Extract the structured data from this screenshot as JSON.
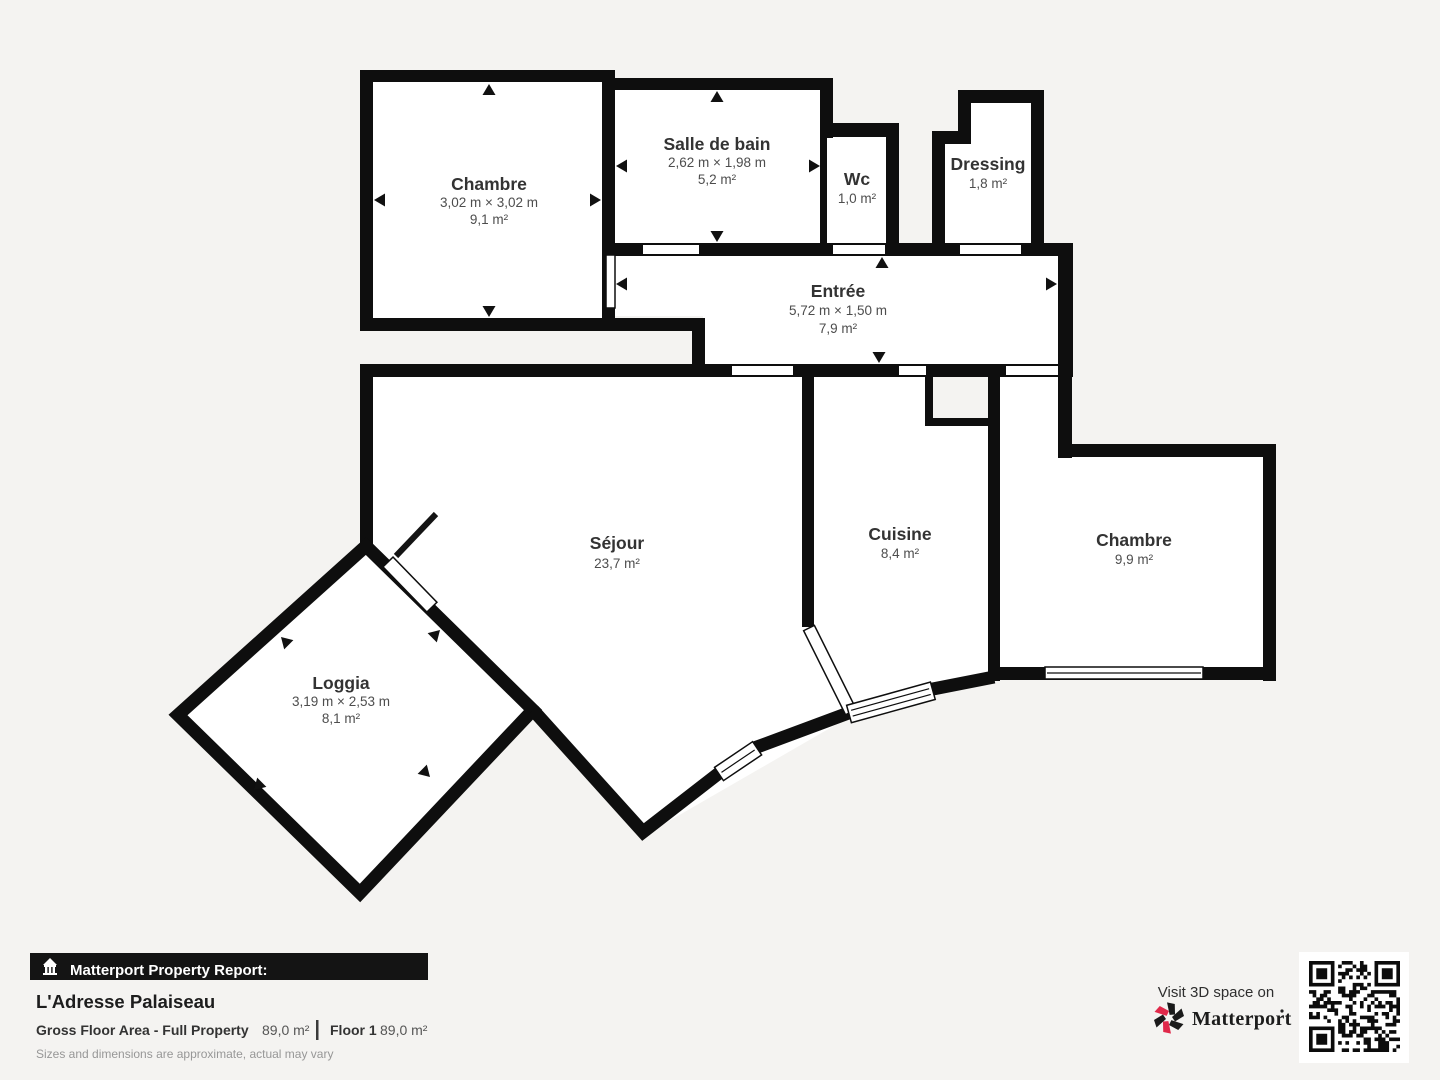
{
  "page": {
    "background": "#f4f3f1",
    "wall_color": "#0e0e0e",
    "accent_red": "#e0294a"
  },
  "plan": {
    "rooms": {
      "chambre1": {
        "name": "Chambre",
        "dims": "3,02 m × 3,02 m",
        "area": "9,1 m²"
      },
      "salle_de_bain": {
        "name": "Salle de bain",
        "dims": "2,62 m × 1,98 m",
        "area": "5,2 m²"
      },
      "wc": {
        "name": "Wc",
        "area": "1,0 m²"
      },
      "dressing": {
        "name": "Dressing",
        "area": "1,8 m²"
      },
      "entree": {
        "name": "Entrée",
        "dims": "5,72 m × 1,50 m",
        "area": "7,9 m²"
      },
      "sejour": {
        "name": "Séjour",
        "area": "23,7 m²"
      },
      "cuisine": {
        "name": "Cuisine",
        "area": "8,4 m²"
      },
      "chambre2": {
        "name": "Chambre",
        "area": "9,9 m²"
      },
      "loggia": {
        "name": "Loggia",
        "dims": "3,19 m × 2,53 m",
        "area": "8,1 m²"
      }
    }
  },
  "footer": {
    "report_label": "Matterport Property Report:",
    "property_name": "L'Adresse Palaiseau",
    "gfa_label": "Gross Floor Area - Full Property",
    "gfa_value": "89,0 m²",
    "floor_label": "Floor 1",
    "floor_value": "89,0 m²",
    "disclaimer": "Sizes and dimensions are approximate, actual may vary"
  },
  "promo": {
    "visit_label": "Visit 3D space on",
    "brand": "Matterport"
  }
}
